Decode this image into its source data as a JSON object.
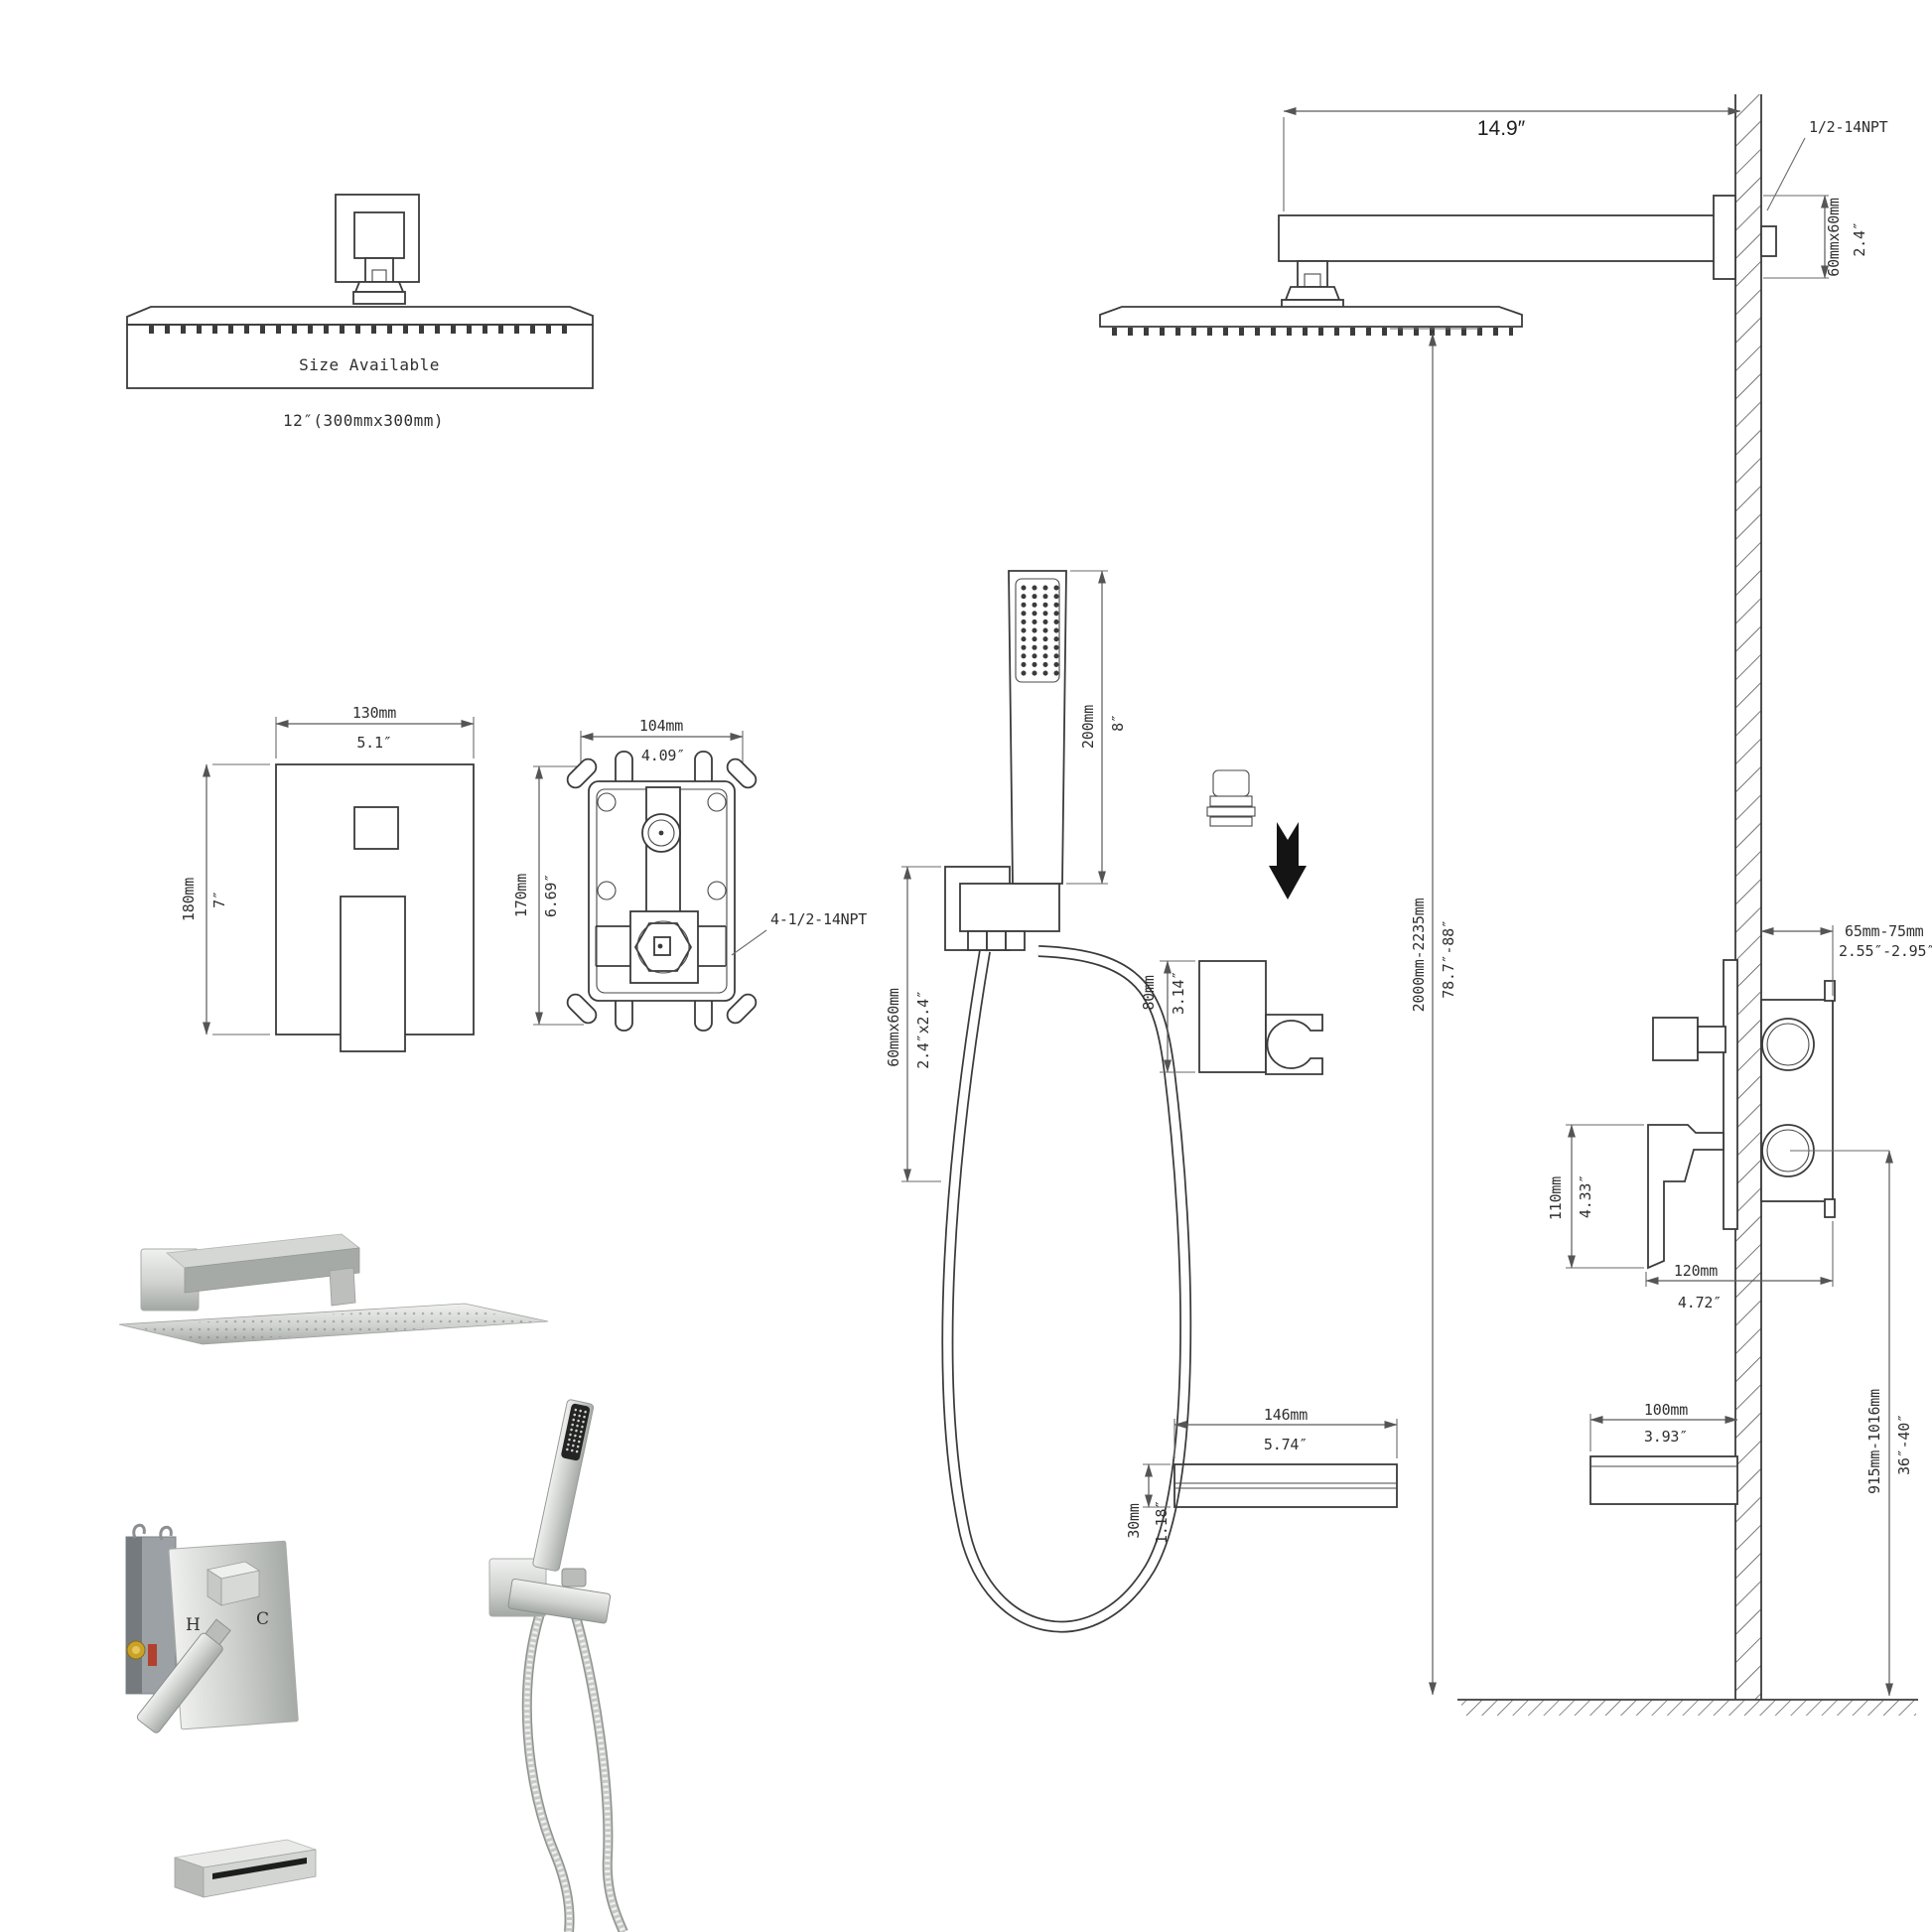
{
  "drawing_title": "Shower system dimension drawing",
  "head_top": {
    "size_available": "Size Available",
    "size_note": "12″(300mmx300mm)"
  },
  "arm": {
    "length_in": "14.9″",
    "thread": "1/2-14NPT",
    "flange_mm": "60mmx60mm",
    "flange_in": "2.4″"
  },
  "trim_plate": {
    "w_mm": "130mm",
    "w_in": "5.1″",
    "h_mm": "180mm",
    "h_in": "7″"
  },
  "rough_valve": {
    "w_mm": "104mm",
    "w_in": "4.09″",
    "h_mm": "170mm",
    "h_in": "6.69″",
    "thread": "4-1/2-14NPT"
  },
  "hand_shower": {
    "length_mm": "200mm",
    "length_in": "8″",
    "outlet_mm": "60mmx60mm",
    "outlet_in": "2.4″x2.4″",
    "holder_mm": "80mm",
    "holder_in": "3.14″"
  },
  "install": {
    "head_height_mm": "2000mm-2235mm",
    "head_height_in": "78.7″-88″",
    "valve_depth_mm": "65mm-75mm",
    "valve_depth_in": "2.55″-2.95″",
    "handle_mm": "110mm",
    "handle_in": "4.33″",
    "trim_w_mm": "120mm",
    "trim_w_in": "4.72″",
    "spout_h_mm": "915mm-1016mm",
    "spout_h_in": "36″-40″"
  },
  "spout_top": {
    "w_mm": "146mm",
    "w_in": "5.74″",
    "h_mm": "30mm",
    "h_in": "1.18″"
  },
  "spout_side": {
    "l_mm": "100mm",
    "l_in": "3.93″"
  },
  "render_labels": {
    "hot": "H",
    "cold": "C"
  },
  "colors": {
    "line": "#3b3b3b",
    "dim": "#6a6a6a",
    "hot": "#b2402f",
    "cold": "#4a6fa5",
    "metal_light": "#eceded",
    "metal_mid": "#c6c9c5",
    "metal_dark": "#9aa09d"
  }
}
